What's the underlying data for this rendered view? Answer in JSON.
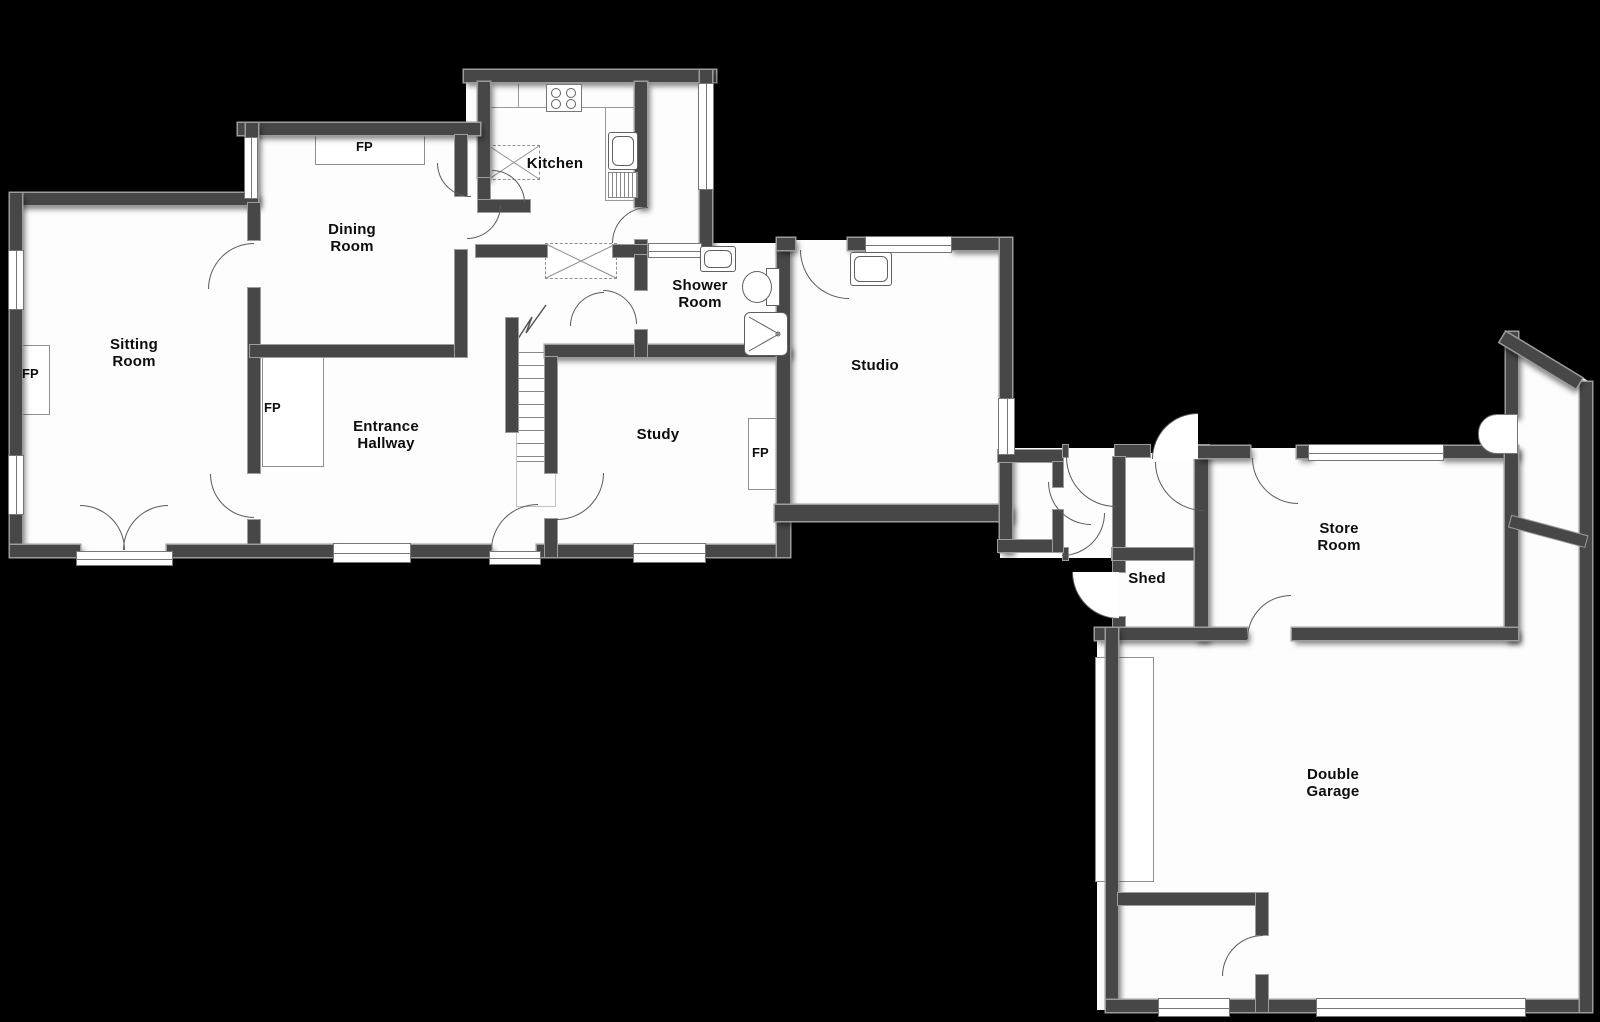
{
  "plan": {
    "rooms": {
      "sitting_room": "Sitting\nRoom",
      "dining_room": "Dining\nRoom",
      "kitchen": "Kitchen",
      "shower_room": "Shower\nRoom",
      "entrance_hallway": "Entrance\nHallway",
      "study": "Study",
      "studio": "Studio",
      "shed": "Shed",
      "store_room": "Store\nRoom",
      "double_garage": "Double\nGarage"
    },
    "fireplace_label": "FP",
    "colors": {
      "background": "#000000",
      "wall": "#474747",
      "wall_outline": "#9c9c9c",
      "floor": "#ffffff",
      "text": "#0d0d0d"
    }
  }
}
